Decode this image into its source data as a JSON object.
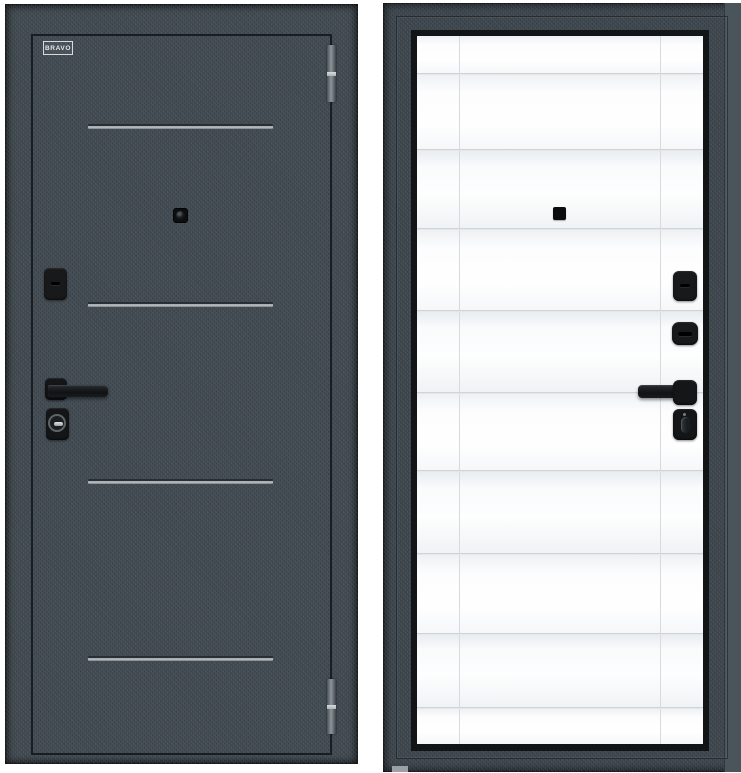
{
  "brand": {
    "label": "BRAVO"
  },
  "colors": {
    "background": "#ffffff",
    "door_dark": "#3f484f",
    "door_dark_deep": "#3b444b",
    "frame_edge_light": "#4a545b",
    "reveal_black": "#111517",
    "leaf_white": "#f3f5f7",
    "leaf_line": "#c9cdd0",
    "hardware_black": "#17191b",
    "metal_silver": "#b7bdc1",
    "strip_silver": "#aab1b6",
    "floor_shadow": "#9aa0a4"
  }
}
